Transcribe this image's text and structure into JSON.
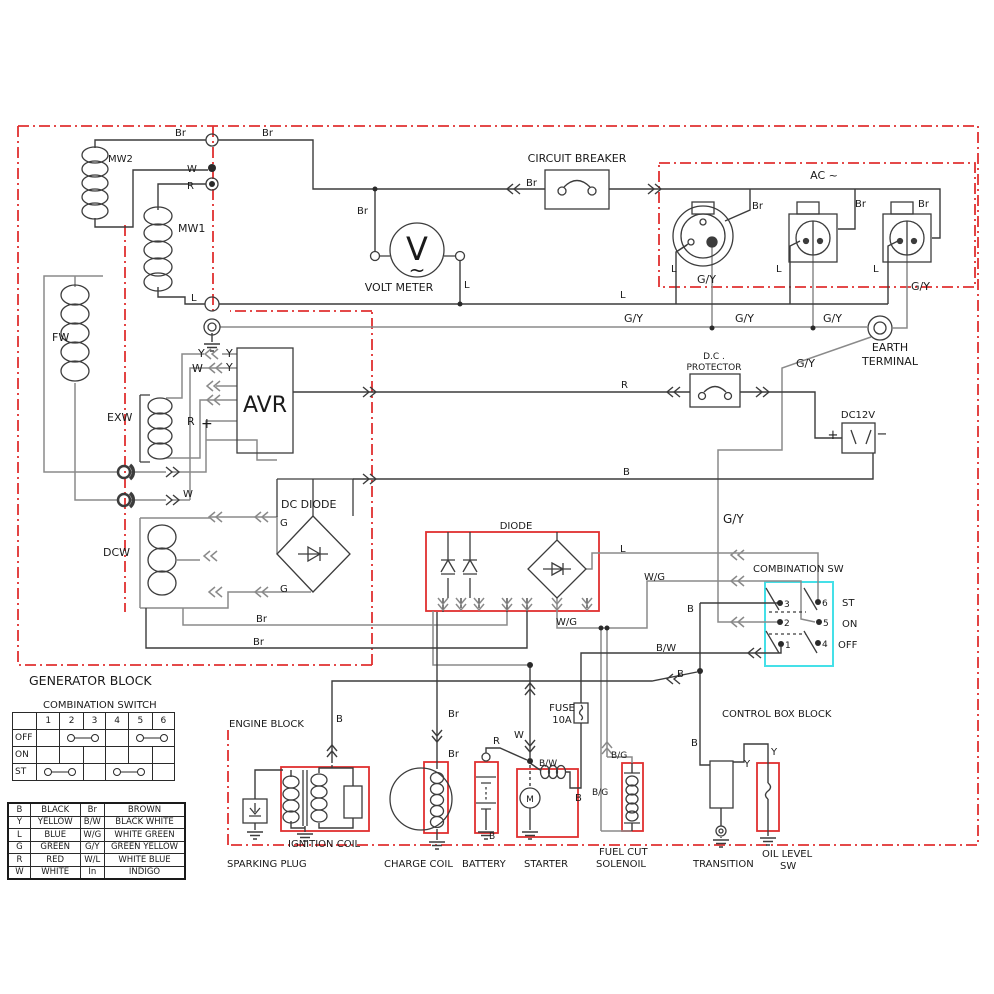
{
  "colors": {
    "red": "#e03030",
    "cyan": "#45e0e8",
    "wire_dark": "#3c3c3c",
    "wire_gray": "#8a8a8a",
    "text": "#1a1a1a"
  },
  "combination_switch_table": {
    "title": "COMBINATION SWITCH",
    "columns": [
      "",
      "1",
      "2",
      "3",
      "4",
      "5",
      "6"
    ],
    "row_labels": [
      "OFF",
      "ON",
      "ST"
    ],
    "connections": {
      "OFF": "2-3, 5-6",
      "ON": "none",
      "ST": "1-2, 4-5"
    }
  },
  "color_table": {
    "rows": [
      [
        "B",
        "BLACK",
        "Br",
        "BROWN"
      ],
      [
        "Y",
        "YELLOW",
        "B/W",
        "BLACK  WHITE"
      ],
      [
        "L",
        "BLUE",
        "W/G",
        "WHITE GREEN"
      ],
      [
        "G",
        "GREEN",
        "G/Y",
        "GREEN YELLOW"
      ],
      [
        "R",
        "RED",
        "W/L",
        "WHITE BLUE"
      ],
      [
        "W",
        "WHITE",
        "In",
        "INDIGO"
      ]
    ]
  },
  "switch": {
    "pins": [
      "1",
      "2",
      "3",
      "4",
      "5",
      "6"
    ],
    "positions": [
      "ST",
      "ON",
      "OFF"
    ]
  },
  "labels": [
    [
      "MW2",
      108,
      162,
      10
    ],
    [
      "Br",
      175,
      136,
      10
    ],
    [
      "W",
      187,
      172,
      10
    ],
    [
      "R",
      187,
      189,
      10
    ],
    [
      "Br",
      262,
      136,
      10
    ],
    [
      "MW1",
      178,
      232,
      11
    ],
    [
      "L",
      191,
      301,
      10
    ],
    [
      "FW",
      52,
      341,
      11
    ],
    [
      "EXW",
      107,
      421,
      11
    ],
    [
      "DCW",
      103,
      556,
      11
    ],
    [
      "CIRCUIT BREAKER",
      577,
      162,
      11,
      "m"
    ],
    [
      "Br",
      526,
      186,
      10
    ],
    [
      "Br",
      357,
      214,
      10
    ],
    [
      "V",
      417,
      260,
      32,
      "m"
    ],
    [
      "~",
      417,
      277,
      20,
      "m"
    ],
    [
      "VOLT METER",
      399,
      291,
      11,
      "m"
    ],
    [
      "L",
      464,
      288,
      10
    ],
    [
      "AC ~",
      824,
      179,
      11,
      "m"
    ],
    [
      "Br",
      752,
      209,
      10
    ],
    [
      "Br",
      855,
      207,
      10
    ],
    [
      "Br",
      918,
      207,
      10
    ],
    [
      "L",
      671,
      272,
      10
    ],
    [
      "L",
      776,
      272,
      10
    ],
    [
      "L",
      873,
      272,
      10
    ],
    [
      "G/Y",
      697,
      283,
      11
    ],
    [
      "G/Y",
      911,
      290,
      11
    ],
    [
      "L",
      620,
      298,
      10
    ],
    [
      "G/Y",
      624,
      322,
      11
    ],
    [
      "G/Y",
      735,
      322,
      11
    ],
    [
      "G/Y",
      823,
      322,
      11
    ],
    [
      "EARTH",
      890,
      351,
      11,
      "m"
    ],
    [
      "TERMINAL",
      890,
      365,
      11,
      "m"
    ],
    [
      "D.C .",
      714,
      359,
      9,
      "m"
    ],
    [
      "PROTECTOR",
      714,
      370,
      9,
      "m"
    ],
    [
      "R",
      621,
      388,
      10
    ],
    [
      "G/Y",
      796,
      367,
      11
    ],
    [
      "DC12V",
      858,
      418,
      10,
      "m"
    ],
    [
      "+",
      833,
      439,
      13,
      "m"
    ],
    [
      "−",
      882,
      438,
      13,
      "m"
    ],
    [
      "B",
      623,
      475,
      10
    ],
    [
      "G/Y",
      723,
      523,
      12
    ],
    [
      "AVR",
      265,
      412,
      22,
      "m"
    ],
    [
      "Y",
      198,
      357,
      11
    ],
    [
      "Y",
      226,
      357,
      11
    ],
    [
      "W",
      192,
      372,
      11
    ],
    [
      "Y",
      226,
      371,
      11
    ],
    [
      "R",
      187,
      425,
      11
    ],
    [
      "+",
      201,
      428,
      14
    ],
    [
      "W",
      183,
      497,
      10
    ],
    [
      "DC DIODE",
      281,
      508,
      11
    ],
    [
      "G",
      280,
      526,
      10
    ],
    [
      "G",
      280,
      592,
      10
    ],
    [
      "Br",
      256,
      622,
      10
    ],
    [
      "Br",
      253,
      645,
      10
    ],
    [
      "DIODE",
      516,
      529,
      10,
      "m"
    ],
    [
      "L",
      620,
      552,
      10
    ],
    [
      "W/G",
      644,
      580,
      10
    ],
    [
      "W/G",
      556,
      625,
      10
    ],
    [
      "B",
      687,
      612,
      10
    ],
    [
      "B/W",
      656,
      651,
      10
    ],
    [
      "B",
      677,
      677,
      10
    ],
    [
      "COMBINATION SW",
      753,
      572,
      10
    ],
    [
      "3",
      784,
      607,
      9
    ],
    [
      "6",
      822,
      606,
      9
    ],
    [
      "2",
      784,
      626,
      9
    ],
    [
      "5",
      823,
      626,
      9
    ],
    [
      "1",
      785,
      648,
      9
    ],
    [
      "4",
      822,
      647,
      9
    ],
    [
      "ST",
      842,
      606,
      10
    ],
    [
      "ON",
      842,
      627,
      10
    ],
    [
      "OFF",
      838,
      648,
      10
    ],
    [
      "GENERATOR BLOCK",
      29,
      685,
      12.5
    ],
    [
      "COMBINATION SWITCH",
      43,
      708,
      10
    ],
    [
      "ENGINE BLOCK",
      229,
      727,
      10
    ],
    [
      "CONTROL BOX BLOCK",
      722,
      717,
      10
    ],
    [
      "B",
      336,
      722,
      10
    ],
    [
      "Br",
      448,
      717,
      10
    ],
    [
      "Br",
      448,
      757,
      10
    ],
    [
      "FUSE",
      562,
      711,
      10,
      "m"
    ],
    [
      "10A",
      562,
      723,
      10,
      "m"
    ],
    [
      "W",
      514,
      738,
      10
    ],
    [
      "R",
      493,
      744,
      10
    ],
    [
      "B/W",
      539,
      766,
      9
    ],
    [
      "B",
      575,
      801,
      10
    ],
    [
      "B/G",
      611,
      758,
      9
    ],
    [
      "B/G",
      592,
      795,
      9
    ],
    [
      "B",
      489,
      839,
      9
    ],
    [
      "M",
      530,
      802,
      9,
      "m"
    ],
    [
      "B",
      691,
      746,
      10
    ],
    [
      "Y",
      744,
      767,
      10
    ],
    [
      "Y",
      771,
      755,
      10
    ],
    [
      "SPARKING PLUG",
      227,
      867,
      10
    ],
    [
      "IGNITION COIL",
      288,
      847,
      10
    ],
    [
      "CHARGE COIL",
      384,
      867,
      10
    ],
    [
      "BATTERY",
      462,
      867,
      10
    ],
    [
      "STARTER",
      524,
      867,
      10
    ],
    [
      "FUEL CUT",
      599,
      855,
      10
    ],
    [
      "SOLENOIL",
      596,
      867,
      10
    ],
    [
      "TRANSITION",
      693,
      867,
      10
    ],
    [
      "OIL LEVEL",
      762,
      857,
      10
    ],
    [
      "SW",
      780,
      869,
      10
    ]
  ]
}
